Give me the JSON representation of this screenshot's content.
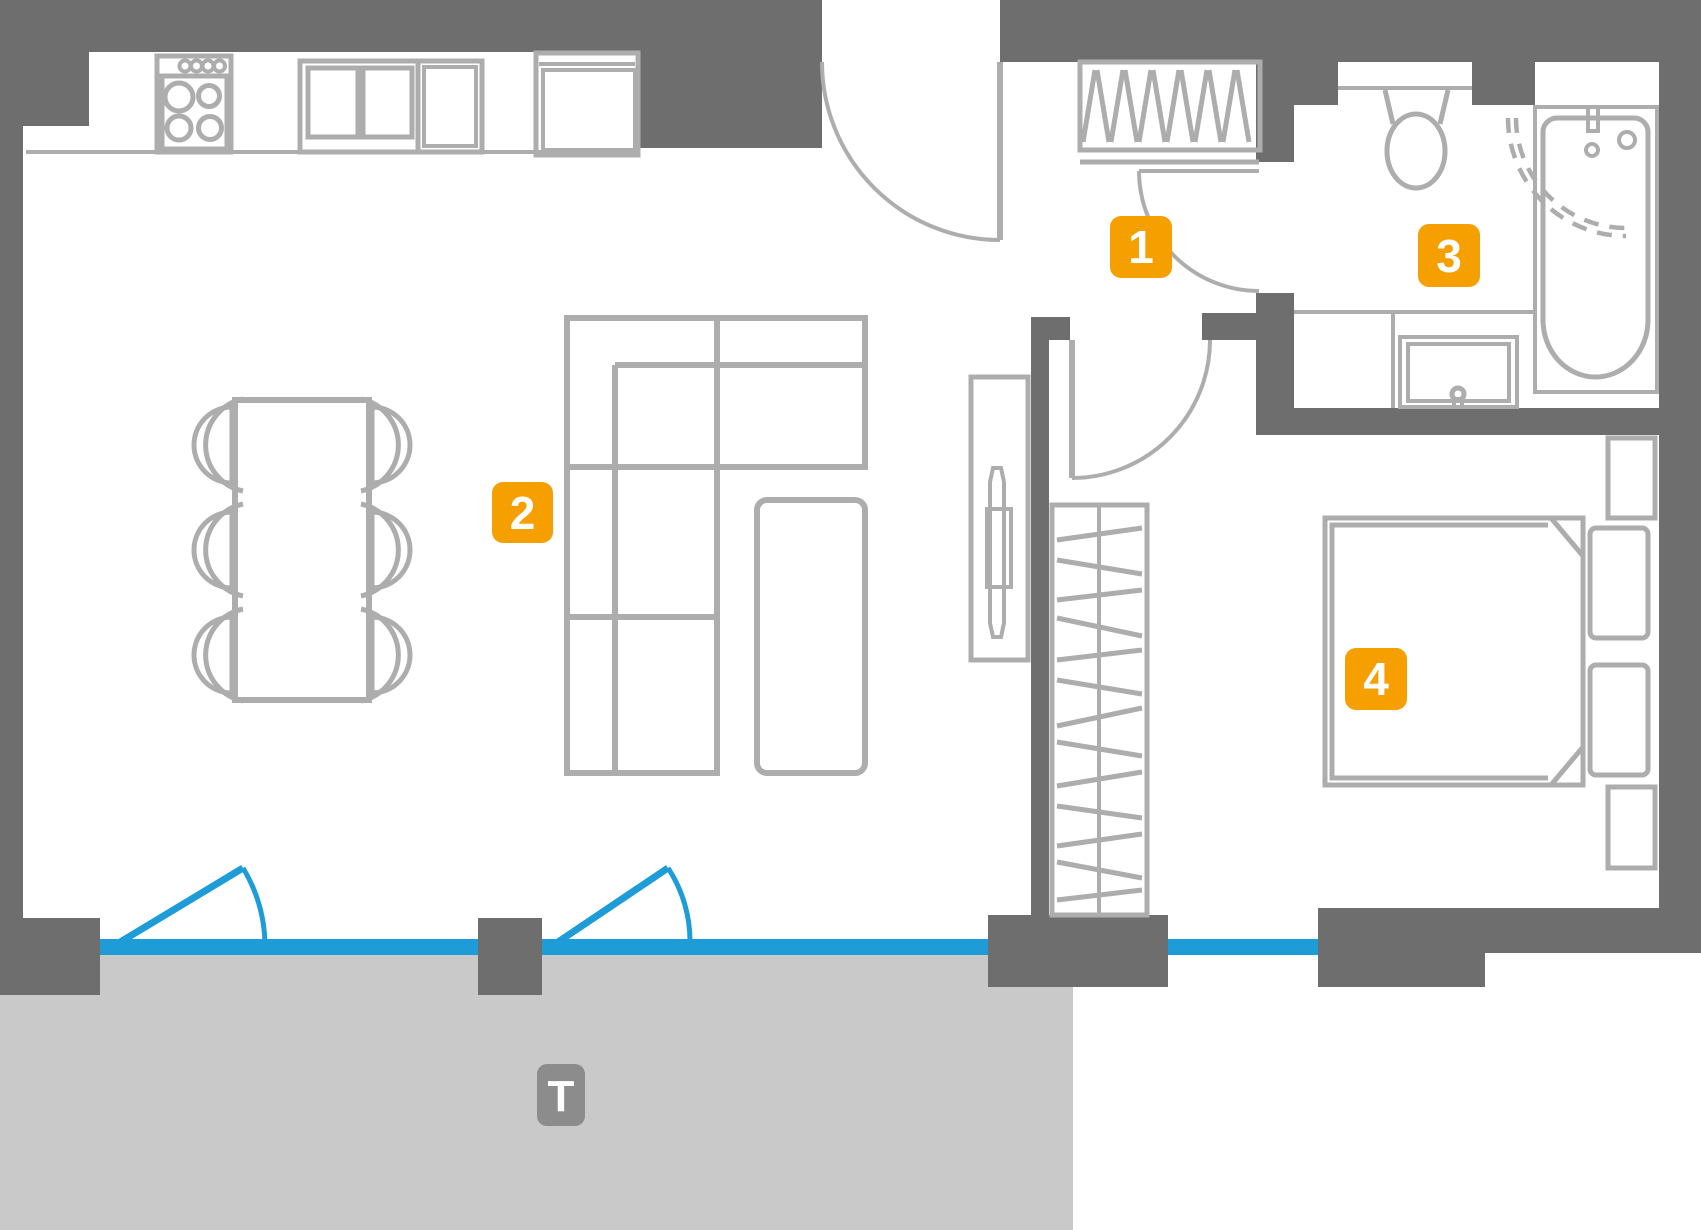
{
  "floor_plan": {
    "markers": [
      {
        "label": "1"
      },
      {
        "label": "2"
      },
      {
        "label": "3"
      },
      {
        "label": "4"
      },
      {
        "label": "T"
      }
    ],
    "colors": {
      "wall_gray": "#6E6E6E",
      "furniture_line_gray": "#ADADAD",
      "terrace_gray": "#C9C9C9",
      "window_blue": "#1E9CD8",
      "room_marker_orange": "#F5A000",
      "terrace_marker_gray": "#8C8C8C"
    }
  }
}
